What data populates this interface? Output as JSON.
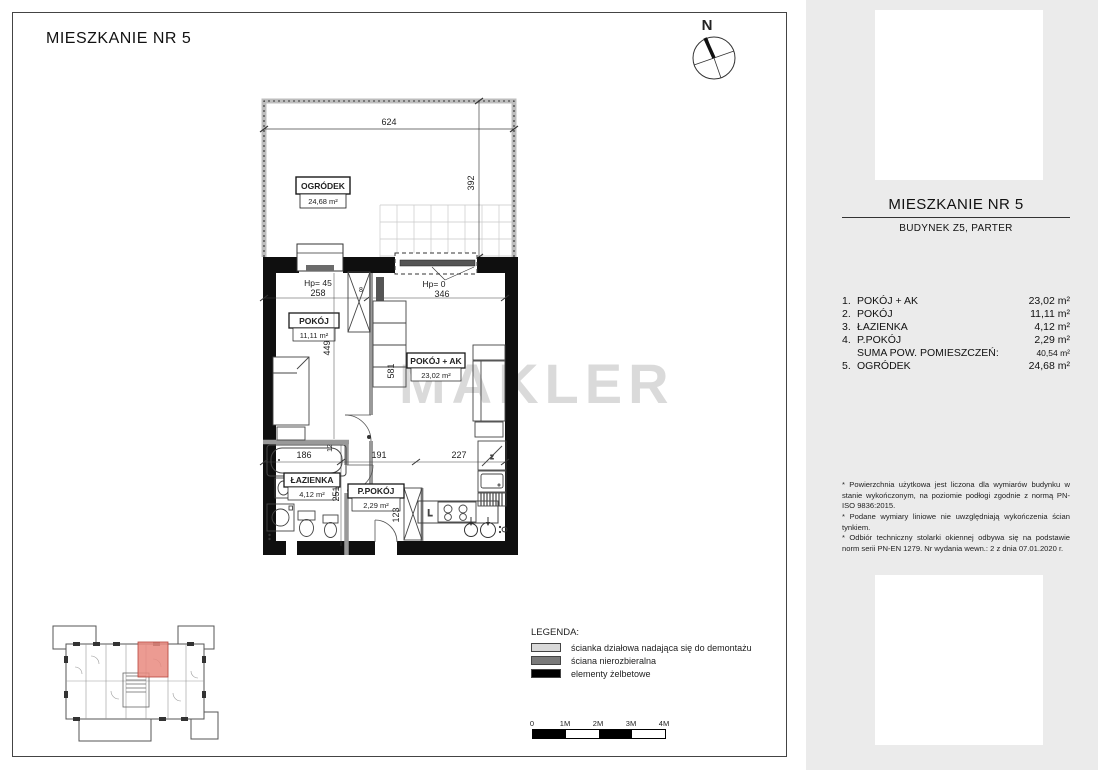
{
  "page_title": "MIESZKANIE NR 5",
  "watermark": "MAKLER",
  "compass": {
    "label": "N"
  },
  "plan": {
    "garden": {
      "label": "OGRÓDEK",
      "area": "24,68 m²",
      "dim_width": "624",
      "dim_depth": "392"
    },
    "rooms": {
      "pokoj": {
        "label": "POKÓJ",
        "area": "11,11 m²"
      },
      "pokoj_ak": {
        "label": "POKÓJ + AK",
        "area": "23,02 m²"
      },
      "lazienka": {
        "label": "ŁAZIENKA",
        "area": "4,12 m²"
      },
      "ppokoj": {
        "label": "P.POKÓJ",
        "area": "2,29 m²"
      }
    },
    "dims": {
      "window_left_sill": "Hp= 45",
      "window_left_width": "258",
      "window_right_sill": "Hp= 0",
      "window_right_width": "346",
      "pokoj_depth": "449",
      "pokoj_ak_depth": "581",
      "bath_width": "186",
      "hall_width": "191",
      "kitchen_width": "227",
      "bath_depth": "251",
      "hall_depth": "123",
      "wall_a": "12",
      "wall_b": "8",
      "kitchen_letter": "L"
    }
  },
  "sidebar": {
    "title": "MIESZKANIE NR 5",
    "subtitle": "BUDYNEK Z5, PARTER",
    "rooms": [
      {
        "no": "1.",
        "name": "POKÓJ + AK",
        "area": "23,02 m²"
      },
      {
        "no": "2.",
        "name": "POKÓJ",
        "area": "11,11 m²"
      },
      {
        "no": "3.",
        "name": "ŁAZIENKA",
        "area": "4,12 m²"
      },
      {
        "no": "4.",
        "name": "P.POKÓJ",
        "area": "2,29 m²"
      },
      {
        "no": "",
        "name": "SUMA POW. POMIESZCZEŃ:",
        "area": "40,54 m²"
      },
      {
        "no": "5.",
        "name": "OGRÓDEK",
        "area": "24,68 m²"
      }
    ],
    "footnotes": [
      "* Powierzchnia użytkowa jest liczona dla wymiarów budynku w stanie wykończonym, na poziomie podłogi zgodnie z normą PN-ISO 9836:2015.",
      "* Podane wymiary liniowe nie uwzględniają wykończenia ścian tynkiem.",
      "* Odbiór techniczny stolarki okiennej odbywa się na podstawie norm serii PN-EN 1279. Nr wydania wewn.: 2 z dnia 07.01.2020 r."
    ]
  },
  "legend": {
    "title": "LEGENDA:",
    "items": [
      {
        "label": "ścianka działowa nadająca się do demontażu",
        "color": "#d9d9d9"
      },
      {
        "label": "ściana nierozbieralna",
        "color": "#7a7a7a"
      },
      {
        "label": "elementy żelbetowe",
        "color": "#000000"
      }
    ]
  },
  "scalebar": {
    "labels": [
      "0",
      "1M",
      "2M",
      "3M",
      "4M"
    ]
  },
  "colors": {
    "sidebar_bg": "#ebebeb",
    "highlight_unit": "#e9897f",
    "watermark": "#dadada",
    "wall": "#0f0f0f",
    "partition": "#999999"
  }
}
